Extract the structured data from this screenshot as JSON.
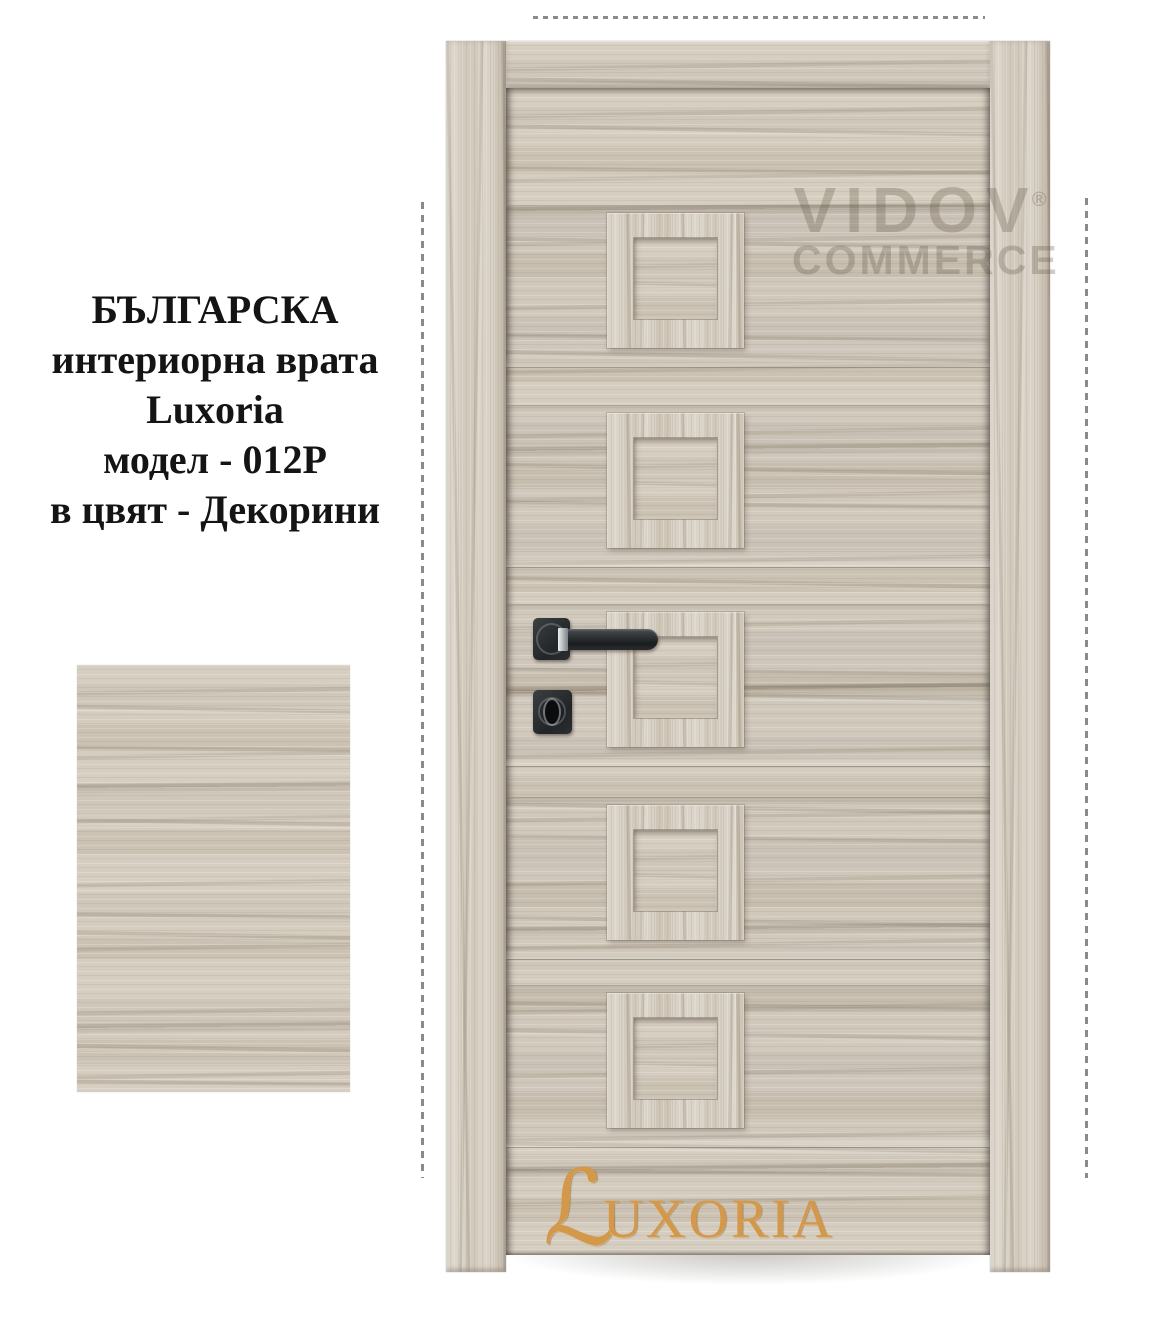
{
  "caption": {
    "lines": [
      "БЪЛГАРСКА",
      "интериорна врата",
      "Luxoria",
      "модел - 012P",
      "в цвят - Декорини"
    ]
  },
  "watermark": {
    "name": "VIDOV",
    "registered_mark": "®",
    "word": "COMMERCE"
  },
  "door": {
    "brand": "Luxoria",
    "model": "012P",
    "decor_name": "Декорини",
    "panel_count": 5,
    "logo_initial": "ℒ",
    "logo_rest": "UXORIA"
  },
  "colors": {
    "wood_base": "#d1c9bc",
    "wood_streak": "#9b8f7c",
    "logo_gold": "#d4984b",
    "hardware_black": "#2b2e30",
    "guide_gray": "#8a8a8a",
    "background": "#ffffff"
  }
}
